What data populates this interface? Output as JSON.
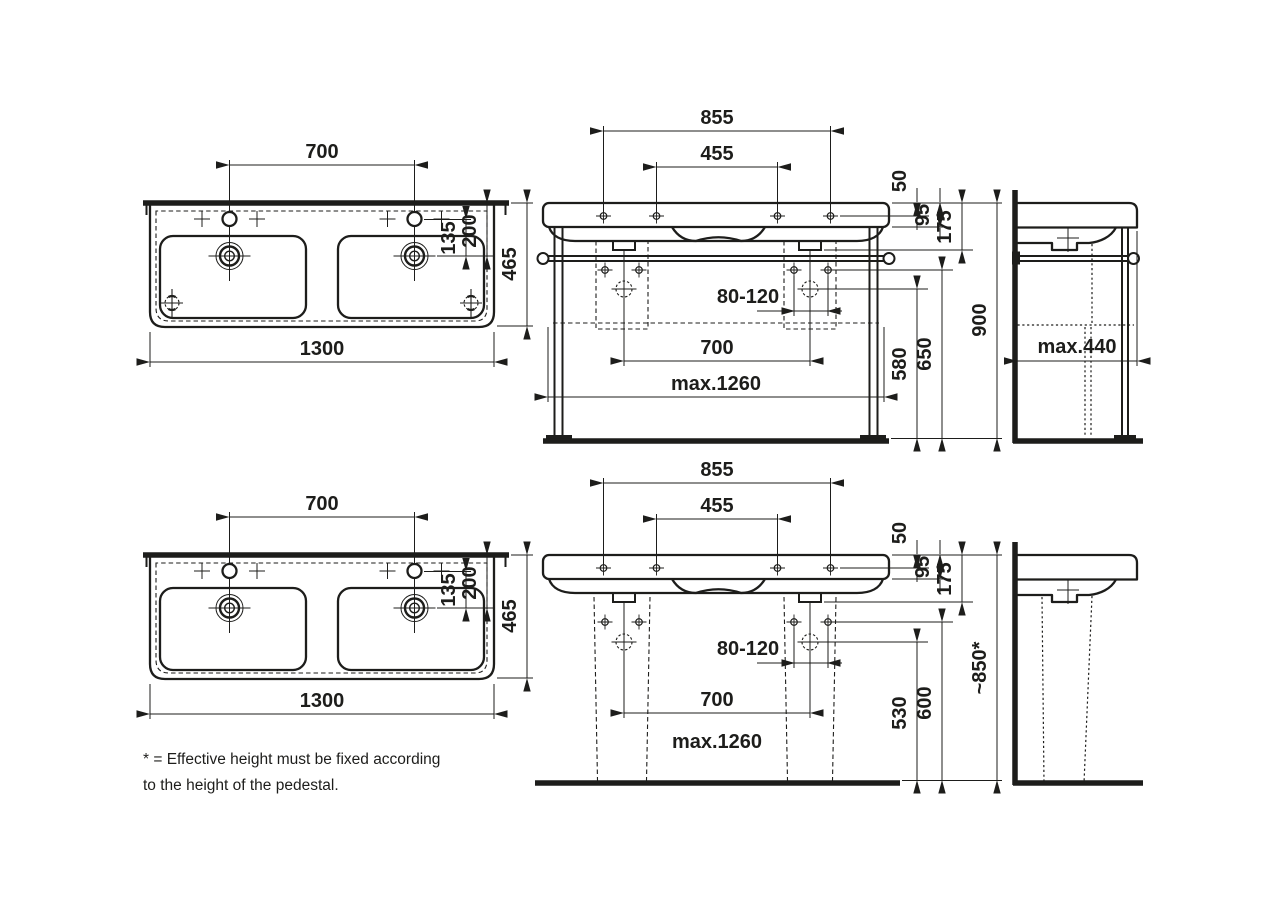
{
  "colors": {
    "ink": "#1d1d1b",
    "paper": "#ffffff"
  },
  "views": {
    "top_plan": {
      "tap_spacing": "700",
      "width": "1300",
      "depth": "465",
      "tap_to_drain": "135",
      "rim_to_drain": "200"
    },
    "top_front": {
      "outer_holes": "855",
      "inner_holes": "455",
      "rim_to_holes": "50",
      "apron": "95",
      "body": "175",
      "drain_range": "80-120",
      "drain_spacing": "700",
      "frame_width": "max.1260",
      "drain_height": "580",
      "bracket_height": "650",
      "total_height": "900"
    },
    "top_side": {
      "depth": "max.440"
    },
    "bottom_plan": {
      "tap_spacing": "700",
      "width": "1300",
      "depth": "465",
      "tap_to_drain": "135",
      "rim_to_drain": "200"
    },
    "bottom_front": {
      "outer_holes": "855",
      "inner_holes": "455",
      "rim_to_holes": "50",
      "apron": "95",
      "body": "175",
      "drain_range": "80-120",
      "drain_spacing": "700",
      "max_width": "max.1260",
      "drain_height": "530",
      "bracket_height": "600",
      "total_height": "~850*"
    }
  },
  "footnote": {
    "line1": "* = Effective height must be fixed according",
    "line2": "to the height of the pedestal."
  }
}
